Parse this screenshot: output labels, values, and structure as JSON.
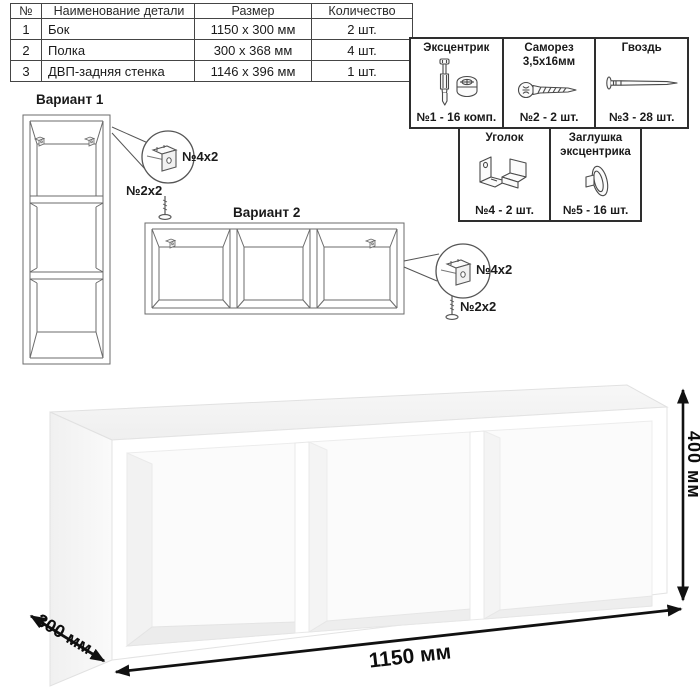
{
  "parts_table": {
    "headers": [
      "№",
      "Наименование детали",
      "Размер",
      "Количество"
    ],
    "rows": [
      {
        "num": "1",
        "name": "Бок",
        "size": "1150 x 300 мм",
        "qty": "2 шт."
      },
      {
        "num": "2",
        "name": "Полка",
        "size": "300 x 368 мм",
        "qty": "4 шт."
      },
      {
        "num": "3",
        "name": "ДВП-задняя стенка",
        "size": "1146 x 396 мм",
        "qty": "1 шт."
      }
    ]
  },
  "hardware": {
    "items": [
      {
        "title_lines": [
          "Эксцентрик"
        ],
        "count": "№1 - 16 комп.",
        "icon": "cam-bolt-icon"
      },
      {
        "title_lines": [
          "Саморез",
          "3,5х16мм"
        ],
        "count": "№2 - 2 шт.",
        "icon": "screw-icon"
      },
      {
        "title_lines": [
          "Гвоздь"
        ],
        "count": "№3 - 28 шт.",
        "icon": "nail-icon"
      },
      {
        "title_lines": [
          "Уголок"
        ],
        "count": "№4 - 2 шт.",
        "icon": "corner-bracket-icon"
      },
      {
        "title_lines": [
          "Заглушка",
          "эксцентрика"
        ],
        "count": "№5 - 16 шт.",
        "icon": "cam-cap-icon"
      }
    ]
  },
  "variants": {
    "v1": {
      "title": "Вариант 1",
      "bracket_label": "№4х2",
      "screw_label": "№2х2"
    },
    "v2": {
      "title": "Вариант 2",
      "bracket_label": "№4х2",
      "screw_label": "№2х2"
    }
  },
  "dimensions": {
    "width": "1150 мм",
    "depth": "300 мм",
    "height": "400 мм"
  },
  "colors": {
    "line": "#6b6b6b",
    "border": "#2e2e2e",
    "dim_arrow": "#111111"
  }
}
